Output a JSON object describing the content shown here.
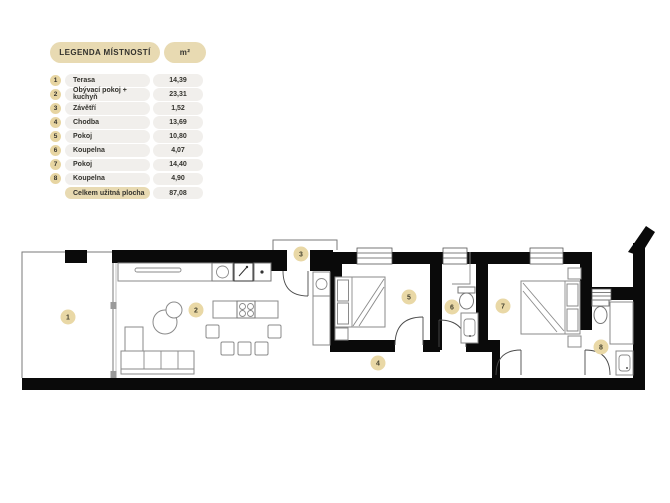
{
  "legend": {
    "title": "LEGENDA MÍSTNOSTÍ",
    "unit_header": "m²",
    "rows": [
      {
        "num": "1",
        "name": "Terasa",
        "area": "14,39"
      },
      {
        "num": "2",
        "name": "Obývací pokoj + kuchyň",
        "area": "23,31"
      },
      {
        "num": "3",
        "name": "Závětří",
        "area": "1,52"
      },
      {
        "num": "4",
        "name": "Chodba",
        "area": "13,69"
      },
      {
        "num": "5",
        "name": "Pokoj",
        "area": "10,80"
      },
      {
        "num": "6",
        "name": "Koupelna",
        "area": "4,07"
      },
      {
        "num": "7",
        "name": "Pokoj",
        "area": "14,40"
      },
      {
        "num": "8",
        "name": "Koupelna",
        "area": "4,90"
      }
    ],
    "total_label": "Celkem užitná plocha",
    "total_value": "87,08"
  },
  "plan": {
    "badges": [
      "1",
      "2",
      "3",
      "4",
      "5",
      "6",
      "7",
      "8"
    ]
  },
  "colors": {
    "accent_tan": "#e8dab2",
    "badge_tan": "#e9d8a6",
    "row_gray": "#f1efec",
    "wall_black": "#0a0a0a",
    "text": "#33322d"
  }
}
